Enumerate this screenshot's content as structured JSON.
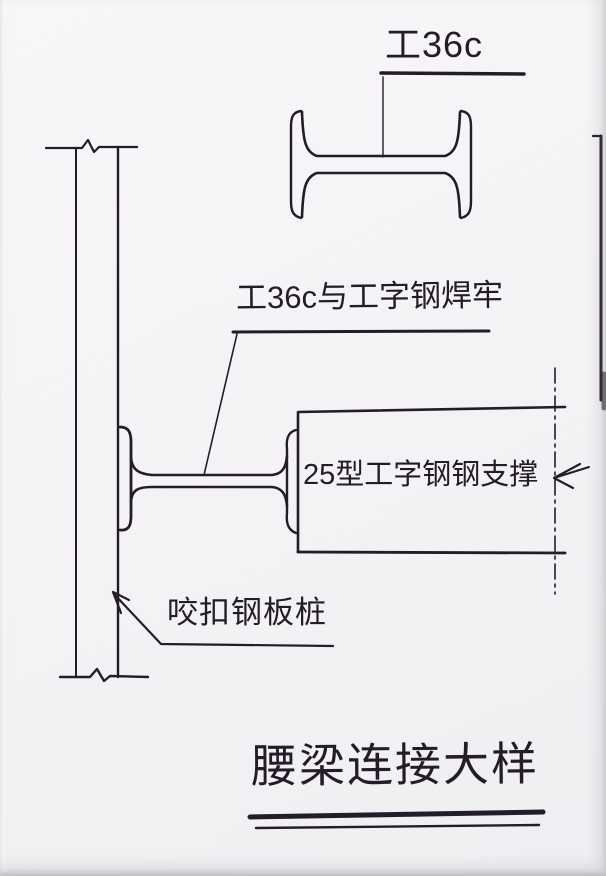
{
  "labels": {
    "top_section_mark": "工36c",
    "weld_note": "工36c与工字钢焊牢",
    "support_label": "25型工字钢钢支撑",
    "sheet_pile_label": "咬扣钢板桩"
  },
  "title": {
    "text": "腰梁连接大样"
  },
  "colors": {
    "ink": "#241c28",
    "paper": "#f4f3f5"
  }
}
